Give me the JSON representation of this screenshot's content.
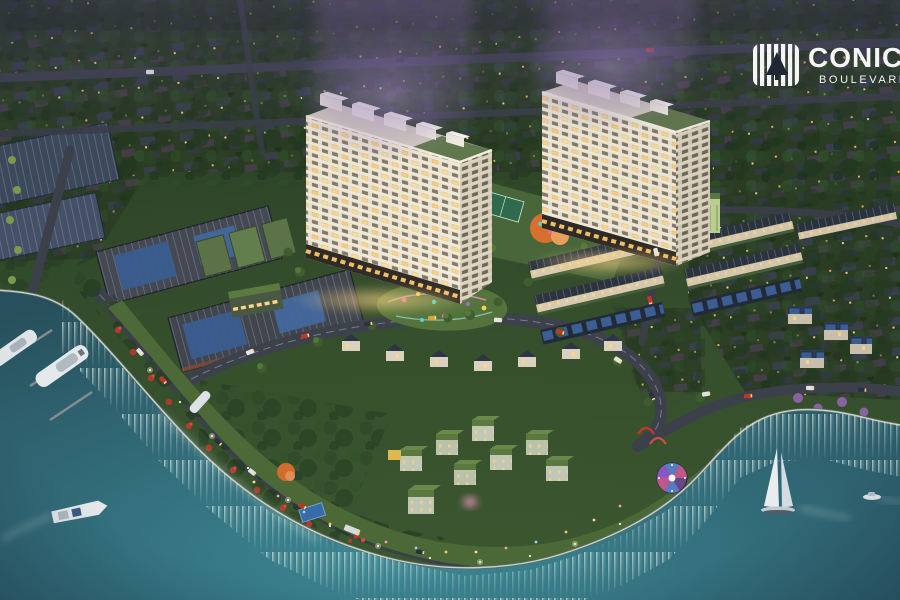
{
  "brand": {
    "name": "CONIC",
    "tagline": "BOULEVARD"
  },
  "palette": {
    "water": "#34707d",
    "water_deep": "#29545f",
    "shore_glow": "#dff0e6",
    "land": "#35502c",
    "land_dark": "#26391f",
    "road": "#3d424c",
    "tower_facade": "#ebe4d1",
    "tower_shadow": "#d3cab4",
    "window_lit": "#ffd78a",
    "roof_slate": "#2c3440",
    "solar_panel": "#3d6096",
    "roof_green": "#5d7c40",
    "bloom": "#a78bd0",
    "flower_red": "#b83a2e",
    "play_orange": "#d9702e",
    "logo_white": "#ffffff"
  },
  "scene": {
    "elements": [
      "river-water",
      "shoreline-embankment",
      "marina-yachts",
      "speedboat",
      "sailboat",
      "motorboat",
      "apartment-tower-west",
      "apartment-tower-east",
      "townhouse-rows",
      "industrial-warehouses",
      "suburban-district",
      "villa-cluster",
      "waterfront-park",
      "playgrounds",
      "carousel-pavilion",
      "boulevard-roads",
      "central-courtyard"
    ]
  }
}
